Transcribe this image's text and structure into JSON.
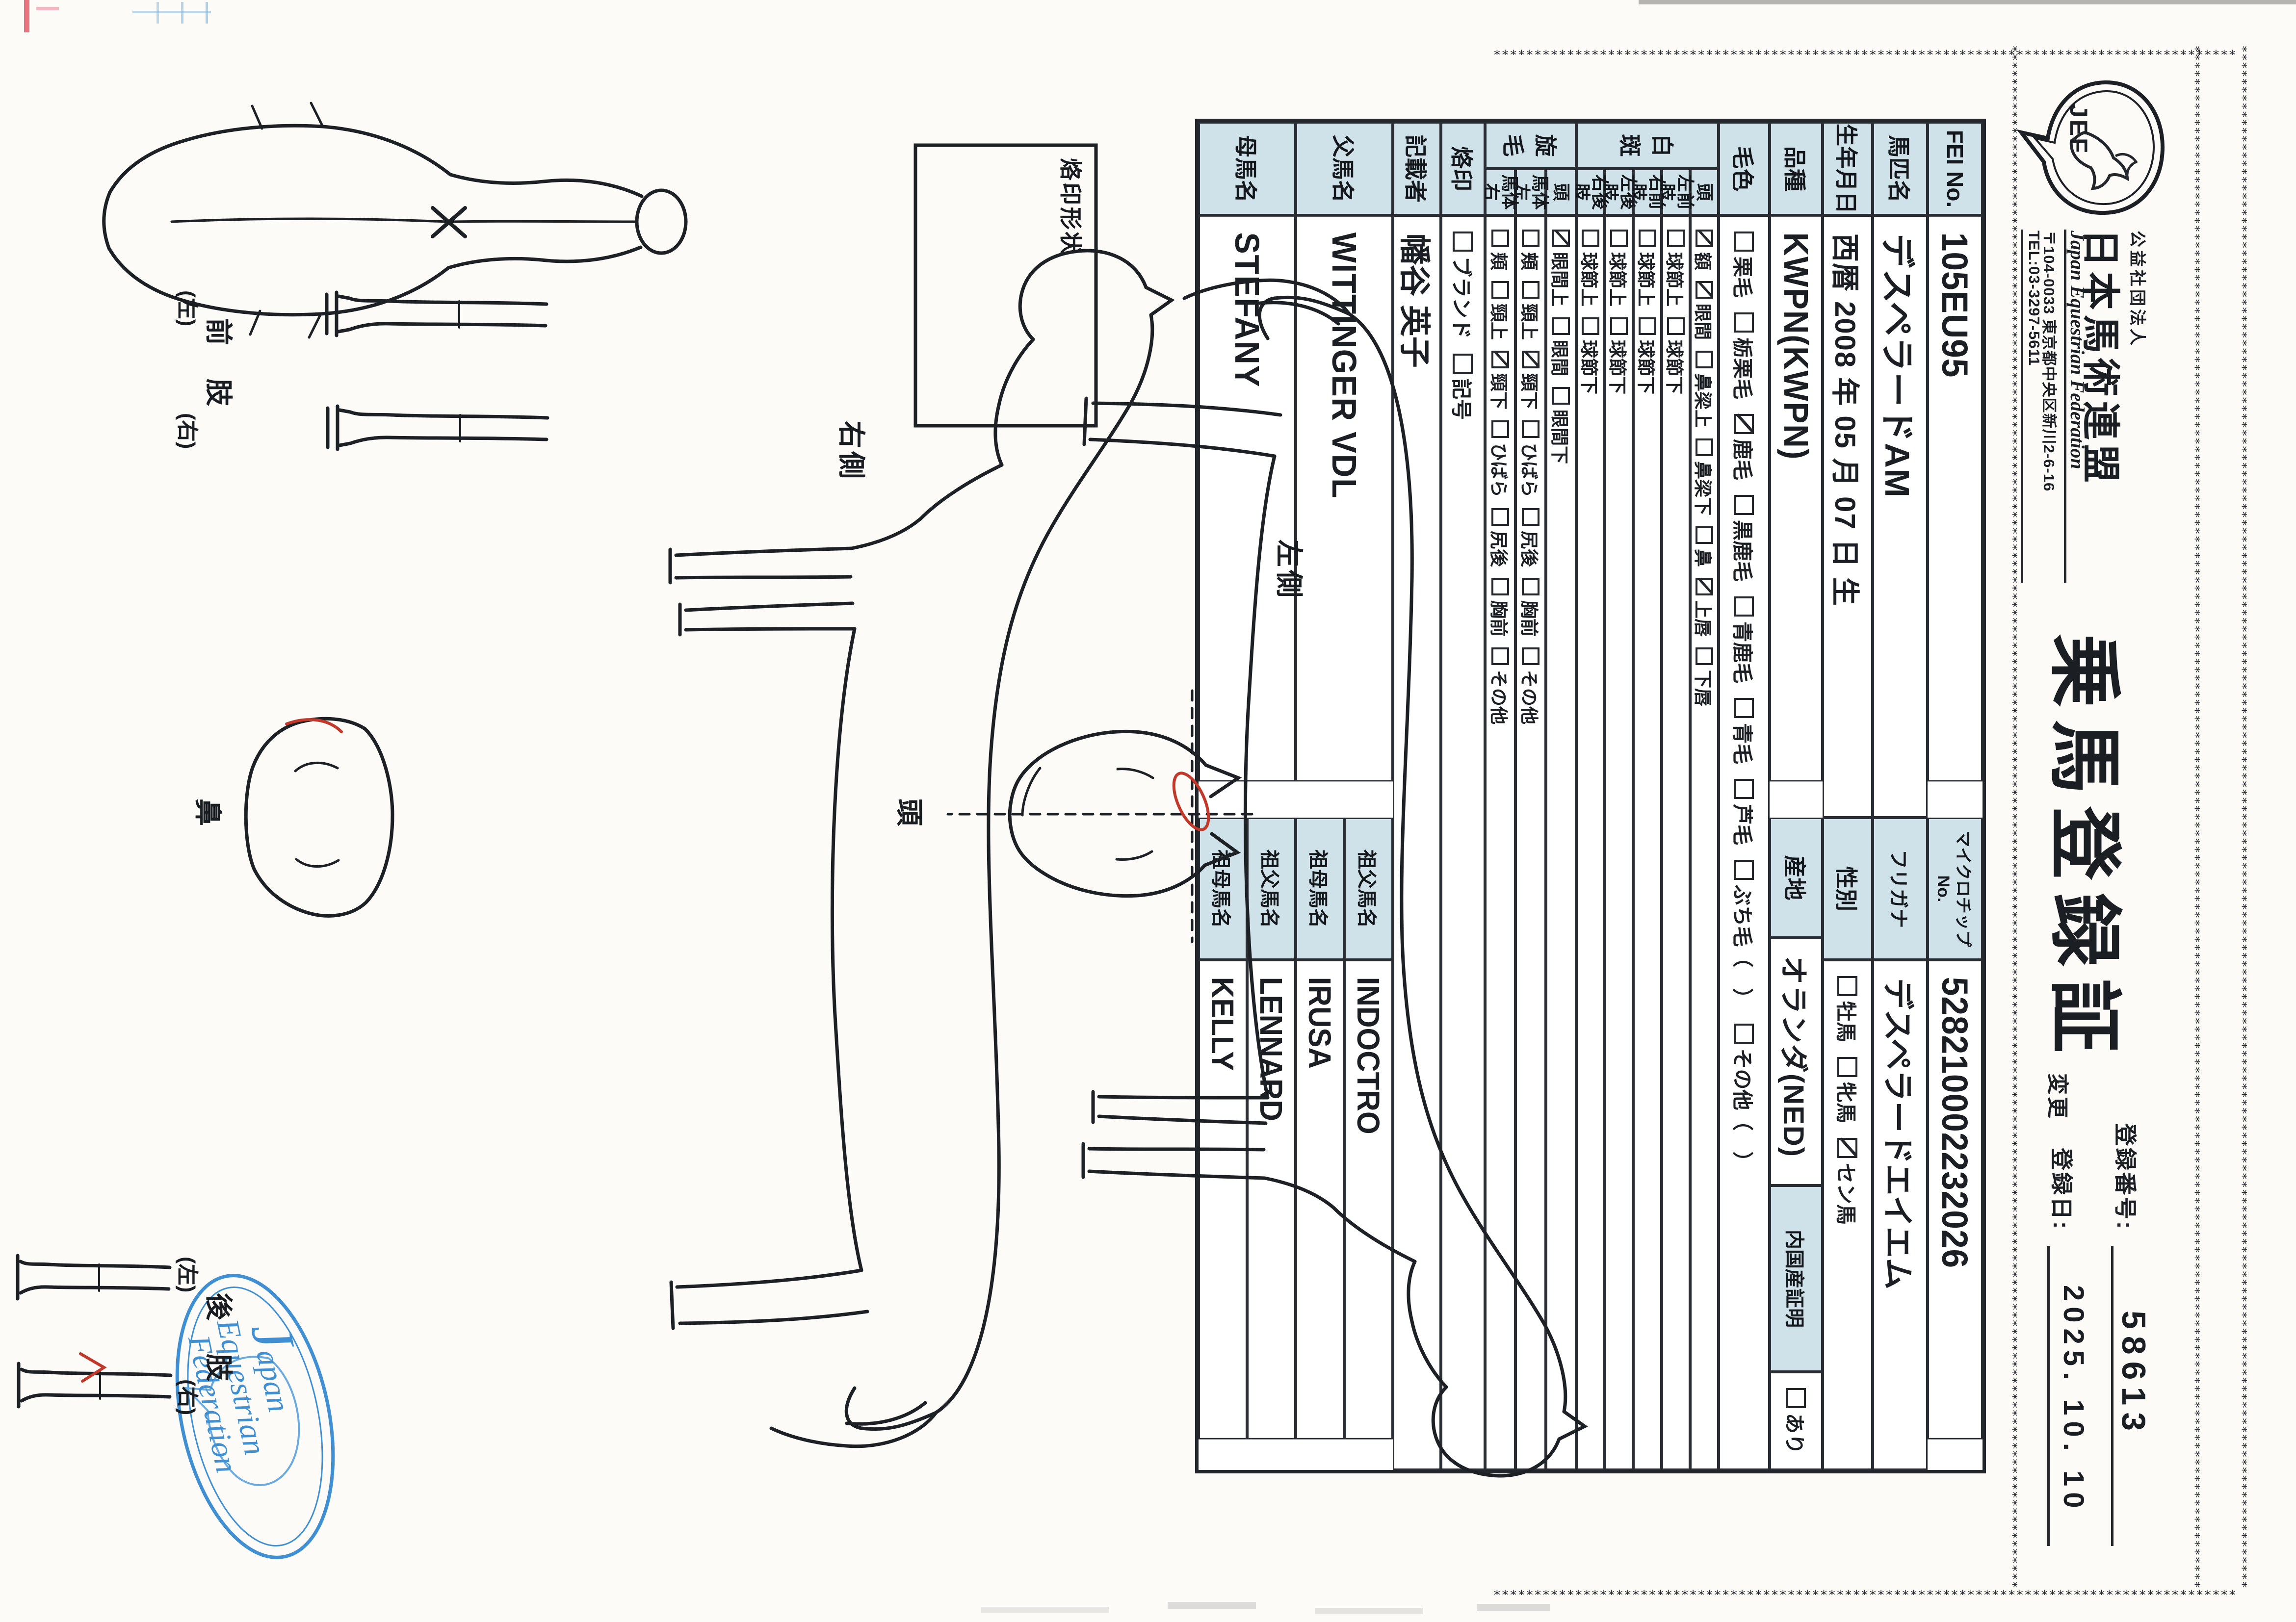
{
  "header": {
    "org_small": "公益社団法人",
    "org_name": "日本馬術連盟",
    "org_en": "Japan Equestrian Federation",
    "address": "〒104-0033 東京都中央区新川2-6-16",
    "tel": "TEL:03-3297-5611",
    "logo_text": "JEF",
    "title": "乗馬登録証",
    "reg_no_label": "登録番号:",
    "reg_no": "58613",
    "change_label": "変更",
    "reg_date_label": "登録日:",
    "reg_date": "2025. 10. 10"
  },
  "table": {
    "fei_label": "FEI No.",
    "fei": "105EU95",
    "chip_label": "マイクロチップNo.",
    "chip": "528210002232026",
    "name_label": "馬匹名",
    "name": "デスペラードAM",
    "kana_label": "フリガナ",
    "kana": "デスペラードエイエム",
    "birth_label": "生年月日",
    "birth": "西暦 2008 年 05 月 07 日 生",
    "sex_label": "性別",
    "sex": [
      {
        "t": "牡馬",
        "c": false
      },
      {
        "t": "牝馬",
        "c": false
      },
      {
        "t": "セン馬",
        "c": true
      }
    ],
    "breed_label": "品種",
    "breed": "KWPN(KWPN)",
    "origin_label": "産地",
    "origin": "オランダ(NED)",
    "domestic_label": "内国産証明",
    "domestic": [
      {
        "t": "あり",
        "c": false
      }
    ],
    "color_label": "毛色",
    "colors": [
      {
        "t": "栗毛",
        "c": false
      },
      {
        "t": "栃栗毛",
        "c": false
      },
      {
        "t": "鹿毛",
        "c": true
      },
      {
        "t": "黒鹿毛",
        "c": false
      },
      {
        "t": "青鹿毛",
        "c": false
      },
      {
        "t": "青毛",
        "c": false
      },
      {
        "t": "芦毛",
        "c": false
      },
      {
        "t": "ぶち毛（　）",
        "c": false
      },
      {
        "t": "その他（　）",
        "c": false
      }
    ],
    "hakuhan_label": "白斑",
    "hk_head_label": "頭",
    "hk_head": [
      {
        "t": "額",
        "c": true
      },
      {
        "t": "眼間",
        "c": true
      },
      {
        "t": "鼻梁上",
        "c": false
      },
      {
        "t": "鼻梁下",
        "c": false
      },
      {
        "t": "鼻",
        "c": false
      },
      {
        "t": "上唇",
        "c": true
      },
      {
        "t": "下唇",
        "c": false
      }
    ],
    "hk_lf_label": "左前肢",
    "hk_rf_label": "右前肢",
    "hk_lh_label": "左後肢",
    "hk_rh_label": "右後肢",
    "hk_legs": [
      {
        "t": "球節上",
        "c": false
      },
      {
        "t": "球節下",
        "c": false
      }
    ],
    "senmou_label": "旋毛",
    "sm_head_label": "頭",
    "sm_head": [
      {
        "t": "眼間上",
        "c": true
      },
      {
        "t": "眼間",
        "c": false
      },
      {
        "t": "眼間下",
        "c": false
      }
    ],
    "sm_left_label": "馬体左",
    "sm_right_label": "馬体右",
    "sm_body": [
      {
        "t": "頬",
        "c": false
      },
      {
        "t": "頸上",
        "c": false
      },
      {
        "t": "頸下",
        "c": true
      },
      {
        "t": "ひばら",
        "c": false
      },
      {
        "t": "尻後",
        "c": false
      },
      {
        "t": "胸前",
        "c": false
      },
      {
        "t": "その他",
        "c": false
      }
    ],
    "brand_label": "烙印",
    "brand": [
      {
        "t": "ブランド",
        "c": false
      },
      {
        "t": "記号",
        "c": false
      }
    ],
    "recorder_label": "記載者",
    "recorder": "幡谷 英子",
    "sire_label": "父馬名",
    "sire": "WITTINGER VDL",
    "sire_sire_label": "祖父馬名",
    "sire_sire": "INDOCTRO",
    "sire_dam_label": "祖母馬名",
    "sire_dam": "IRUSA",
    "dam_label": "母馬名",
    "dam": "STEFANY",
    "dam_sire_label": "祖父馬名",
    "dam_sire": "LENNARD",
    "dam_dam_label": "祖母馬名",
    "dam_dam": "KELLY"
  },
  "diagram": {
    "brand_box_label": "烙印形状",
    "left_view_label": "左側",
    "right_view_label": "右側",
    "head_label": "頭",
    "nose_label": "鼻",
    "foreleg_label": "前　肢",
    "hindleg_label": "後　肢",
    "left_paren": "(左)",
    "right_paren": "(右)",
    "stamp_line1": "Japan",
    "stamp_line2": "Equestrian",
    "stamp_line3": "Federation",
    "stamp_color": "#2f86cf",
    "label_cell_color": "#cfe1e9",
    "red_mark_color": "#c0392b"
  }
}
